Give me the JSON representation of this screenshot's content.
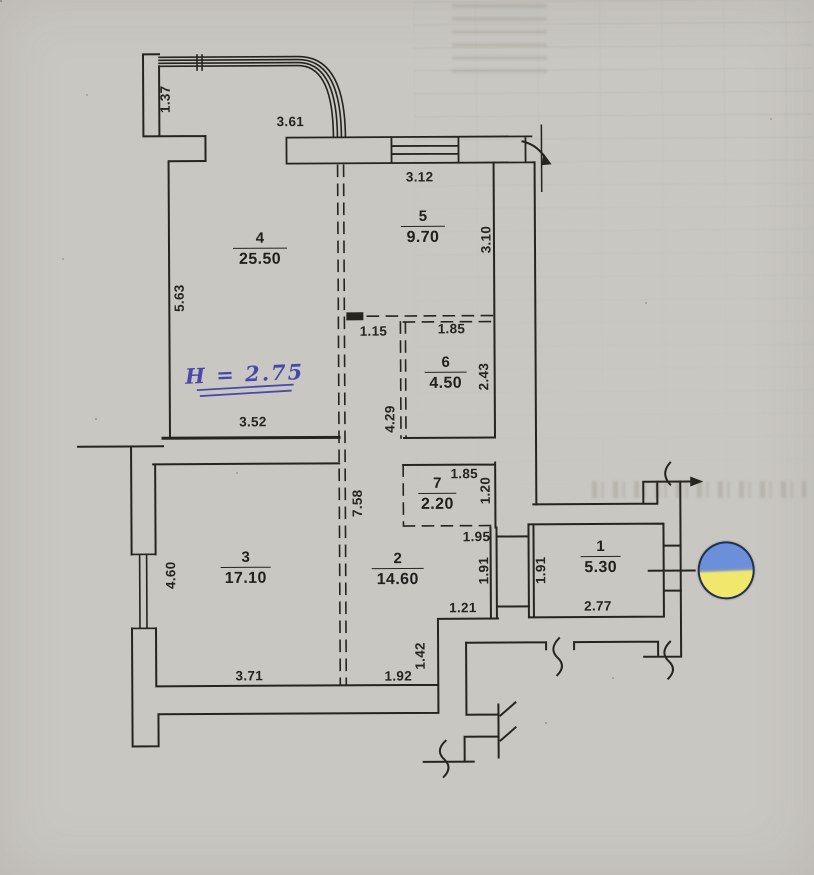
{
  "rooms": {
    "r1": {
      "number": "1",
      "area": "5.30"
    },
    "r2": {
      "number": "2",
      "area": "14.60"
    },
    "r3": {
      "number": "3",
      "area": "17.10"
    },
    "r4": {
      "number": "4",
      "area": "25.50"
    },
    "r5": {
      "number": "5",
      "area": "9.70"
    },
    "r6": {
      "number": "6",
      "area": "4.50"
    },
    "r7": {
      "number": "7",
      "area": "2.20"
    }
  },
  "dimensions": {
    "d137": "1.37",
    "d361": "3.61",
    "d312": "3.12",
    "d310": "3.10",
    "d563": "5.63",
    "d115": "1.15",
    "d185a": "1.85",
    "d243": "2.43",
    "d429": "4.29",
    "d352": "3.52",
    "d185b": "1.85",
    "d120": "1.20",
    "d195": "1.95",
    "d758": "7.58",
    "d460": "4.60",
    "d191a": "1.91",
    "d191b": "1.91",
    "d121": "1.21",
    "d277": "2.77",
    "d142": "1.42",
    "d371": "3.71",
    "d192": "1.92"
  },
  "annotations": {
    "ceiling_height": "H = 2.75"
  },
  "sticker": {
    "name": "ukraine-flag",
    "blue": "#6b8fd8",
    "yellow": "#f2e76d",
    "outline": "#22304f"
  },
  "colors": {
    "paper": "#e9e7e2",
    "ink": "#26241f",
    "blue_ink": "#4946ac"
  }
}
